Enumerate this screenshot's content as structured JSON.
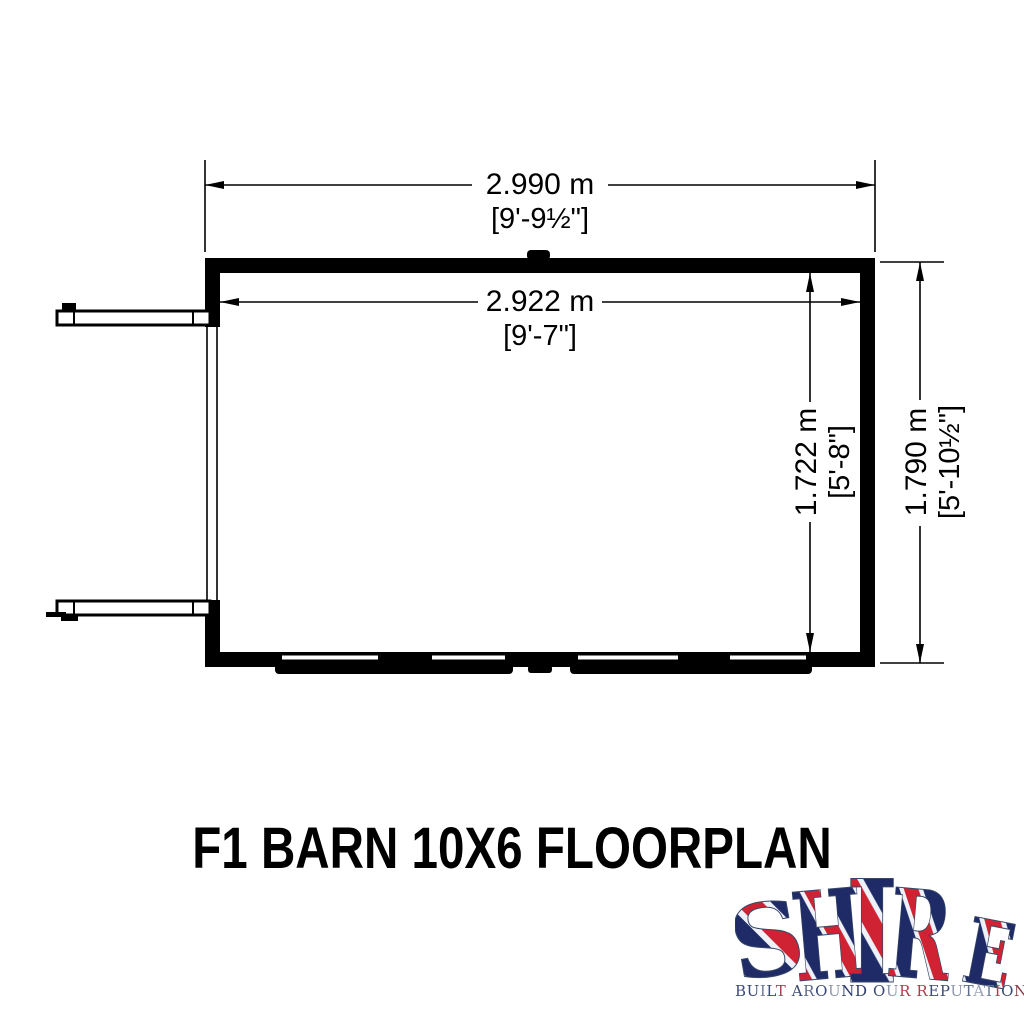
{
  "title": "F1 BARN 10X6 FLOORPLAN",
  "dimensions": {
    "outer_width_m": "2.990 m",
    "outer_width_ft": "[9'-9½\"]",
    "inner_width_m": "2.922 m",
    "inner_width_ft": "[9'-7\"]",
    "inner_depth_m": "1.722 m",
    "inner_depth_ft": "[5'-8\"]",
    "outer_depth_m": "1.790 m",
    "outer_depth_ft": "[5'-10½\"]"
  },
  "logo": {
    "brand": "SHIRE",
    "letters": [
      "S",
      "H",
      "I",
      "R",
      "E"
    ],
    "tagline": "BUILT AROUND OUR REPUTATION",
    "tagline_colors": [
      "#3b4a77",
      "#3b4a77",
      "#6d7b99",
      "#3b4a77",
      "#a34153",
      "",
      "#3b4a77",
      "#5c6b8c",
      "#3b4a77",
      "#8e97ac",
      "#2e3d6d",
      "#2e3d6d",
      "",
      "#3b4a77",
      "#8e97ac",
      "#a8404a",
      "",
      "#a8404a",
      "#3b4a77",
      "#3b4a77",
      "#8e97ac",
      "#5c6b8c",
      "#9aa3b6",
      "#6d7b99",
      "#a8404a",
      "#3b4a77",
      "#8b3b46"
    ],
    "colors": {
      "flag_red": "#cf2233",
      "flag_blue": "#1f2b66",
      "flag_white": "#eef2f8"
    }
  },
  "drawing_color": "#000000"
}
